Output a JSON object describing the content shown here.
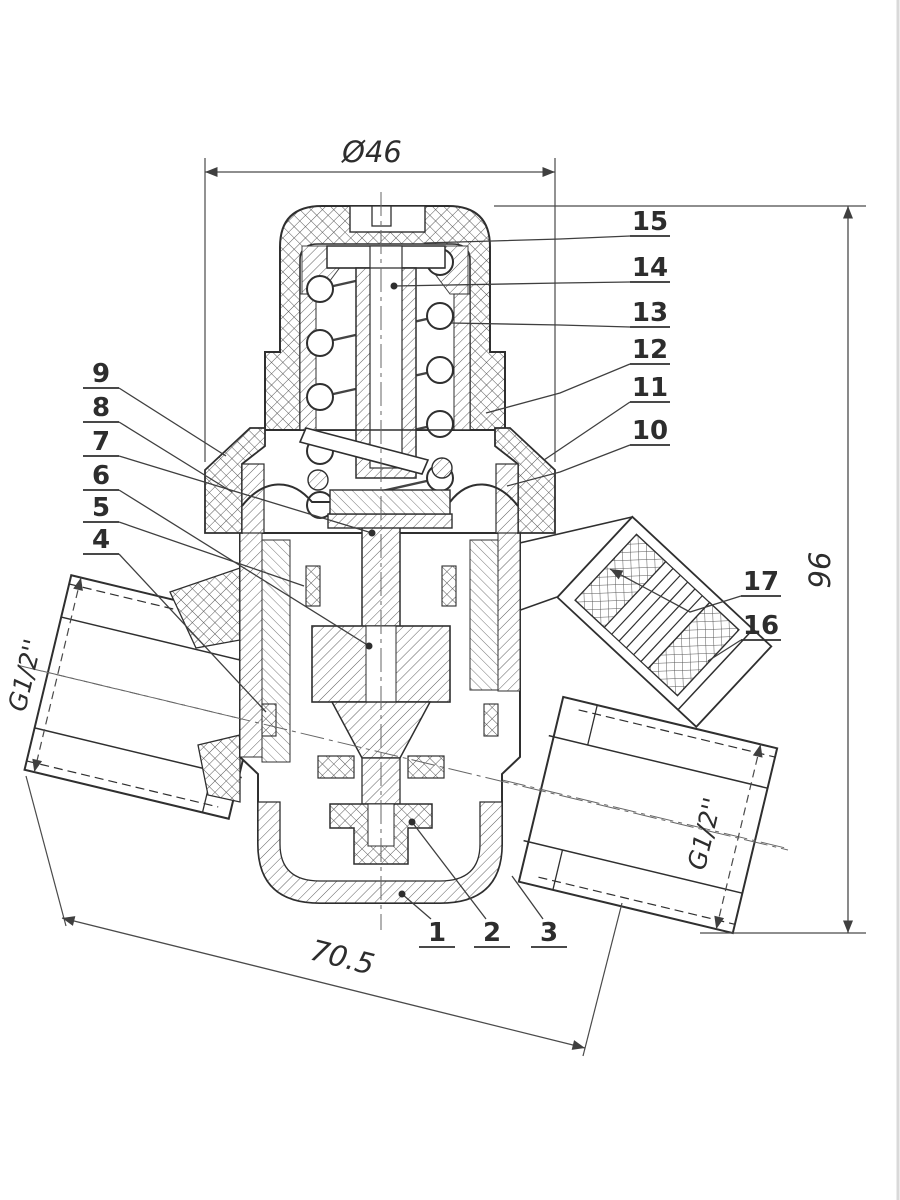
{
  "dimensions": {
    "cap_diameter": "Ø46",
    "overall_height": "96",
    "overall_width": "70.5",
    "left_port_thread": "G1/2''",
    "right_port_thread": "G1/2''"
  },
  "callouts": {
    "right": [
      "15",
      "14",
      "13",
      "12",
      "11",
      "10"
    ],
    "left": [
      "9",
      "8",
      "7",
      "6",
      "5",
      "4"
    ],
    "bottom": [
      "1",
      "2",
      "3"
    ],
    "filter": [
      "17",
      "16"
    ]
  },
  "colors": {
    "line": "#2d2d2d",
    "dim_line": "#4a4a4a",
    "hatch": "#5f5f5f",
    "background": "#ffffff"
  }
}
